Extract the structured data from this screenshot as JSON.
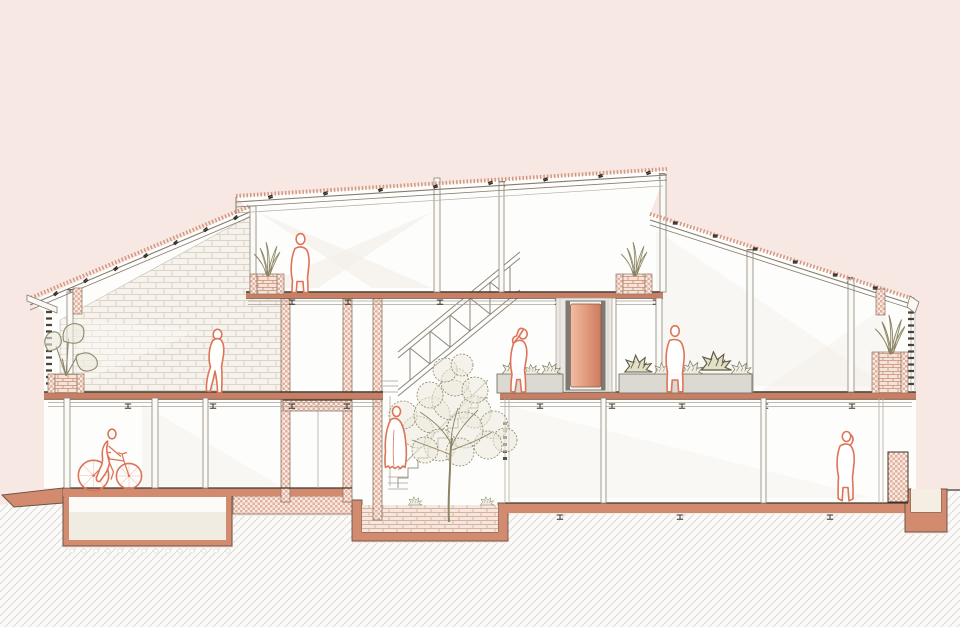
{
  "canvas": {
    "width": 960,
    "height": 627
  },
  "scene": {
    "kind": "architectural-cross-section",
    "levels": [
      "basement-cellar",
      "ground-floor",
      "second-floor",
      "mezzanine"
    ],
    "roof_planes": [
      "left-mono-pitch-roof",
      "central-clerestory-roof",
      "right-mono-pitch-roof"
    ]
  },
  "colors": {
    "background": "#f8e8e4",
    "interior_white": "#fdfdfb",
    "terracotta": "#d38b70",
    "terracotta_deep": "#c97f63",
    "outline_dark": "#6b5547",
    "slab_top_line": "#3e362e",
    "structure_line": "#8d8478",
    "light_structure": "#aaa296",
    "figure_outline": "#dd7458",
    "foliage": "#8b8565",
    "foliage_fill": "#eceadd",
    "planter_gray": "#dcd9d3",
    "planter_edge": "#77726a",
    "brick_joint": "#ddd3c8",
    "brick_bg": "#f6f2ec",
    "pot_brick_line": "#cf8a70",
    "paving_line": "#d8b2a0",
    "ground_hatch_line": "#dcdad5",
    "checker_salmon": "#e2b09c",
    "door_gradient_light": "#f2bca6",
    "door_gradient_dark": "#cc7c5f",
    "louver_dash": "#4a423a",
    "glare": "#f3ede8"
  },
  "elements": [
    {
      "name": "street-ramp",
      "kind": "terrain"
    },
    {
      "name": "basement-cellar-box",
      "kind": "structure"
    },
    {
      "name": "foundation-band",
      "kind": "structure"
    },
    {
      "name": "courtyard-planting-bed",
      "kind": "structure"
    },
    {
      "name": "foundation-trench",
      "kind": "structure"
    },
    {
      "name": "ground-hatch",
      "kind": "terrain"
    },
    {
      "name": "brick-gable-wall",
      "kind": "wall"
    },
    {
      "name": "core-wall",
      "kind": "wall",
      "count": 3
    },
    {
      "name": "floor-slab",
      "kind": "slab",
      "count": 4
    },
    {
      "name": "stair-with-truss-railing",
      "kind": "stair"
    },
    {
      "name": "courtyard-tree",
      "kind": "vegetation"
    },
    {
      "name": "pink-sliding-door",
      "kind": "door"
    },
    {
      "name": "gray-planter-bench",
      "kind": "planter",
      "count": 2
    },
    {
      "name": "brick-pot-planter",
      "kind": "planter",
      "count": 4
    },
    {
      "name": "louver-vent-column",
      "kind": "facade",
      "count": 2
    }
  ],
  "figures": [
    {
      "name": "figure-cyclist",
      "location": "ground-floor-left"
    },
    {
      "name": "figure-walking-person",
      "location": "second-floor-left"
    },
    {
      "name": "figure-standing-person-mezzanine",
      "location": "mezzanine"
    },
    {
      "name": "figure-robed-person",
      "location": "courtyard-stair"
    },
    {
      "name": "figure-drinking-person",
      "location": "second-floor-center"
    },
    {
      "name": "figure-standing-person-hall",
      "location": "second-floor-right"
    },
    {
      "name": "figure-person-on-phone",
      "location": "ground-floor-right"
    }
  ]
}
